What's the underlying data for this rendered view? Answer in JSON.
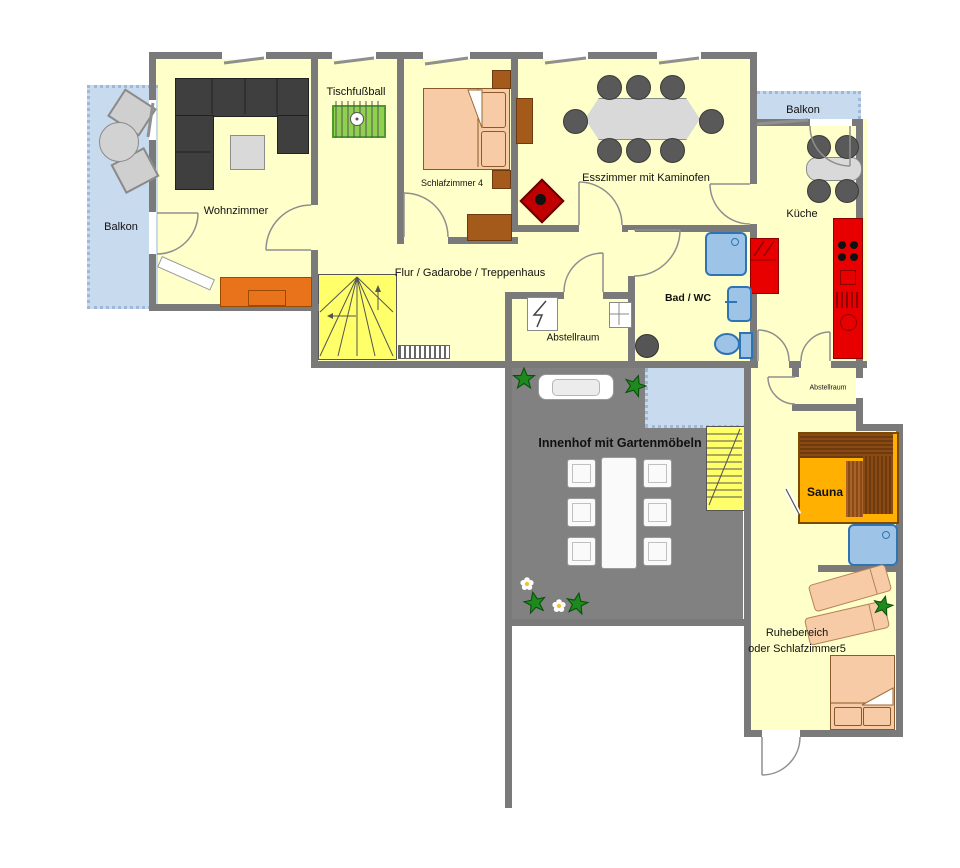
{
  "type": "floor-plan",
  "rooms": {
    "balkon_left": {
      "label": "Balkon"
    },
    "wohnzimmer": {
      "label": "Wohnzimmer"
    },
    "tischfussball": {
      "label": "Tischfußball"
    },
    "schlafzimmer4": {
      "label": "Schlafzimmer 4"
    },
    "esszimmer": {
      "label": "Esszimmer mit Kaminofen"
    },
    "balkon_top": {
      "label": "Balkon"
    },
    "kueche": {
      "label": "Küche"
    },
    "flur": {
      "label": "Flur / Gadarobe / Treppenhaus"
    },
    "bad": {
      "label": "Bad / WC"
    },
    "abstellraum_mid": {
      "label": "Abstellraum"
    },
    "abstellraum_right": {
      "label": "Abstellraum"
    },
    "innenhof": {
      "label": "Innenhof mit Gartenmöbeln"
    },
    "sauna": {
      "label": "Sauna"
    },
    "ruhebereich": {
      "label_line1": "Ruhebereich",
      "label_line2": "oder Schlafzimmer5"
    }
  },
  "colors": {
    "floor": "#FFFFC9",
    "wall": "#7A7A7A",
    "balcony": "#C7DAEE",
    "courtyard": "#818181",
    "stairs": "#FFFF69",
    "sofa": "#3F3F3F",
    "bed": "#F6CBA6",
    "wood_furniture": "#A35A1A",
    "sideboard": "#E8731A",
    "kitchen_appliance": "#E80000",
    "sanitary": "#9DC3E6",
    "sauna_floor": "#FFB000",
    "sauna_bench": "#7B3F10",
    "foosball": "#8FD14F",
    "plant": "#1E8A1E",
    "garden_furniture": "#FAFAFA",
    "dining_table": "#D9D9D9",
    "dining_chair": "#595959",
    "wood_stove": "#C00000"
  }
}
